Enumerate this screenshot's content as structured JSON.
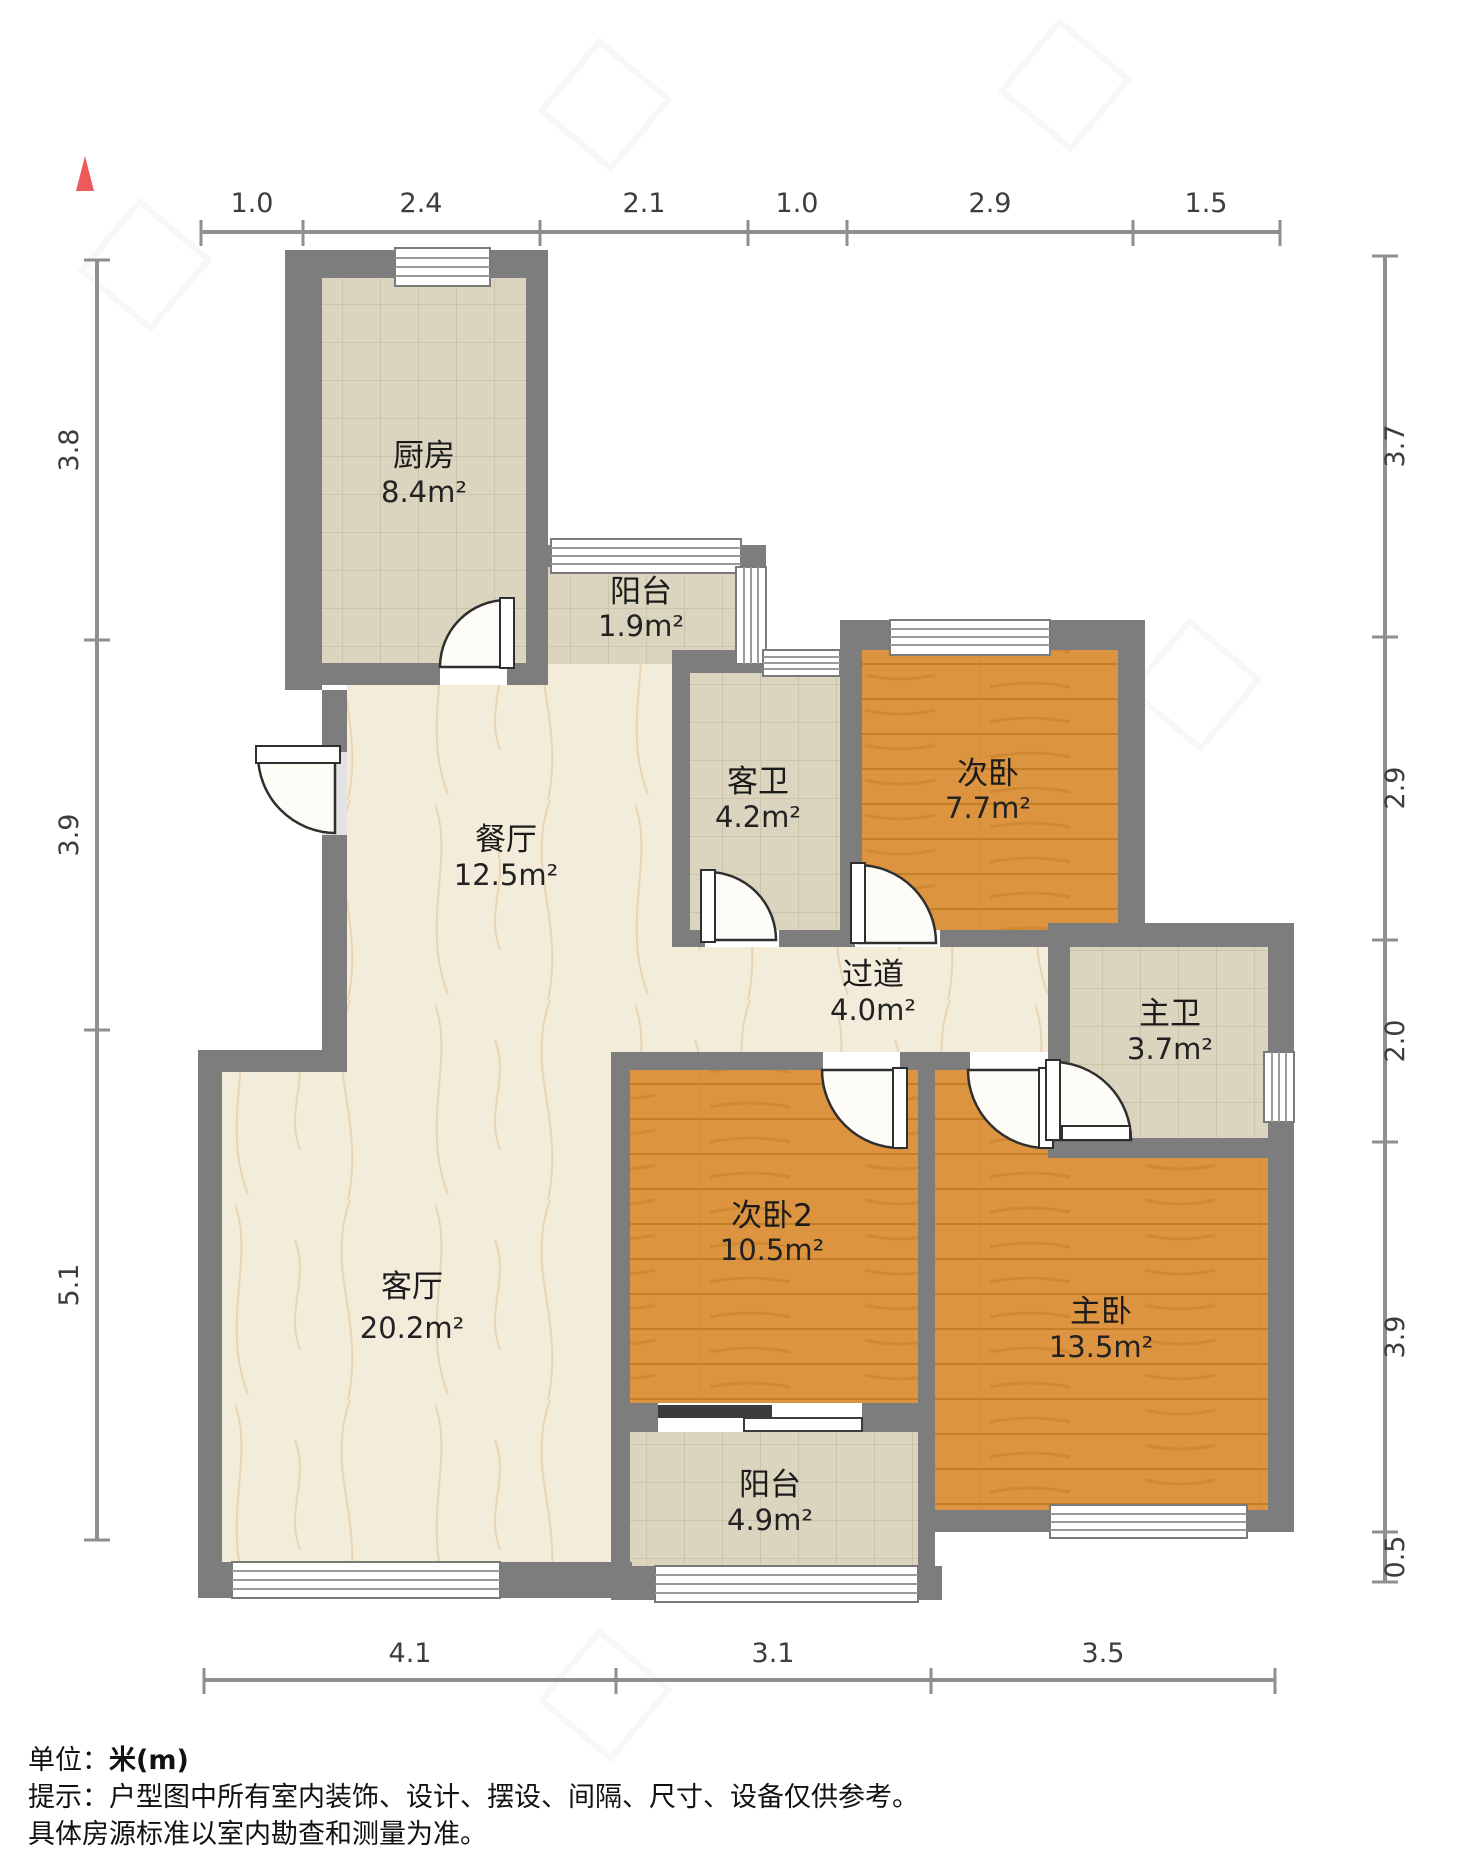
{
  "north": {
    "symbol": "north-arrow",
    "color": "#ee5a5a"
  },
  "rooms": {
    "kitchen": {
      "name": "厨房",
      "area": "8.4m²"
    },
    "balcony_top": {
      "name": "阳台",
      "area": "1.9m²"
    },
    "guest_bathroom": {
      "name": "客卫",
      "area": "4.2m²"
    },
    "second_bedroom": {
      "name": "次卧",
      "area": "7.7m²"
    },
    "dining": {
      "name": "餐厅",
      "area": "12.5m²"
    },
    "hallway": {
      "name": "过道",
      "area": "4.0m²"
    },
    "master_bathroom": {
      "name": "主卫",
      "area": "3.7m²"
    },
    "second_bedroom_2": {
      "name": "次卧2",
      "area": "10.5m²"
    },
    "living": {
      "name": "客厅",
      "area": "20.2m²"
    },
    "master_bedroom": {
      "name": "主卧",
      "area": "13.5m²"
    },
    "balcony_bottom": {
      "name": "阳台",
      "area": "4.9m²"
    }
  },
  "dimensions": {
    "top": [
      "1.0",
      "2.4",
      "2.1",
      "1.0",
      "2.9",
      "1.5"
    ],
    "bottom": [
      "4.1",
      "3.1",
      "3.5"
    ],
    "left": [
      "3.8",
      "3.9",
      "5.1"
    ],
    "right": [
      "3.7",
      "2.9",
      "2.0",
      "3.9",
      "0.5"
    ]
  },
  "footer": {
    "unit_label": "单位：",
    "unit_value": "米(m)",
    "tip_line1": "提示：户型图中所有室内装饰、设计、摆设、间隔、尺寸、设备仅供参考。",
    "tip_line2": "具体房源标准以室内勘查和测量为准。"
  },
  "colors": {
    "wall": "#7d7d7d",
    "wood_floor": "#dd9440",
    "tile_floor": "#dbd5bf",
    "marble_floor": "#f3ecda",
    "dimension_text": "#3d3d3d"
  }
}
